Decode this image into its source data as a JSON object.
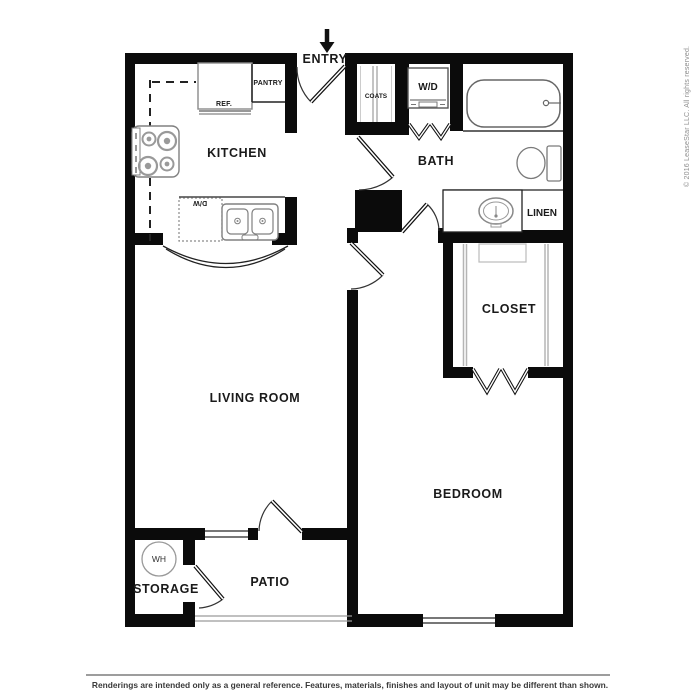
{
  "plan": {
    "entry": {
      "label": "ENTRY"
    },
    "rooms": {
      "kitchen": "KITCHEN",
      "living_room": "LIVING ROOM",
      "bedroom": "BEDROOM",
      "bath": "BATH",
      "closet": "CLOSET",
      "patio": "PATIO",
      "storage": "STORAGE",
      "linen": "LINEN",
      "pantry": "PANTRY",
      "coats": "COATS"
    },
    "fixtures": {
      "refrigerator": "REF.",
      "dishwasher": "D/W",
      "washer_dryer": "W/D",
      "water_heater": "WH"
    }
  },
  "watermark": {
    "copyright": "© 2016 LeaseStar LLC. All rights reserved."
  },
  "footer": {
    "disclaimer": "Renderings are intended only as a general reference. Features, materials, finishes and layout of unit may be different than shown."
  },
  "colors": {
    "background": "#ffffff",
    "wall": "#0b0b0b",
    "fixture_line": "#888888",
    "label_text": "#1a1a1a",
    "copyright_text": "#8e8e8e",
    "disclaimer_text": "#3a3a3a"
  }
}
